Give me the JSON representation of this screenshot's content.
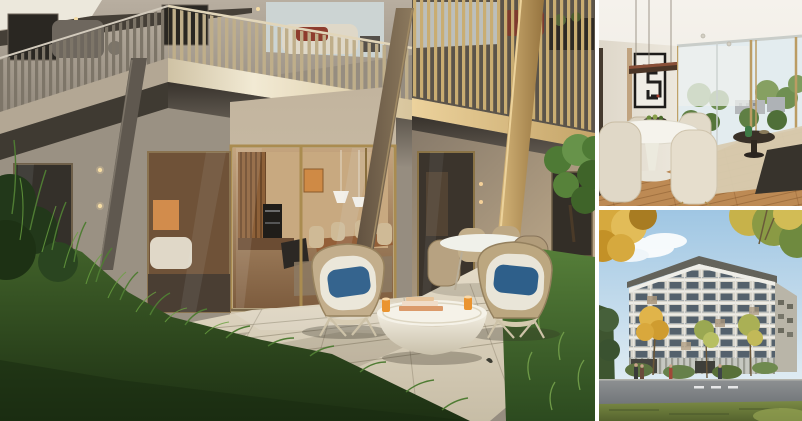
{
  "window": {
    "background": "#ffffff"
  },
  "gallery": {
    "layout": {
      "total_width": 802,
      "total_height": 421,
      "left_panel_width": 595,
      "right_panel_width": 203,
      "right_top_height": 206,
      "right_bottom_height": 211,
      "gap_px": 4,
      "gap_color": "#ffffff"
    },
    "panels": [
      {
        "id": "terrace-exterior",
        "alt": "Rendering of a ground-floor apartment terrace: balconies with vertical slat railings above, open glazed doors showing a warm kitchen and dining room, a stone patio with two rattan lounge chairs with blue cushions, a round white coffee table with books and drinks, an outdoor dining set, and tall grasses in the foreground"
      },
      {
        "id": "dining-interior",
        "alt": "Rendering of a bright dining interior: round white pedestal table with a fruit bowl, cream upholstered chairs, black framed abstract artwork, a dark linear pendant lamp, floor-to-ceiling windows with trees outside and an oak wood floor"
      },
      {
        "id": "building-exterior",
        "alt": "Rendering of a multi-storey residential building with gridded balconies under a blue sky with clouds, framed by autumn trees, with a lawn, street and small figures in the foreground"
      }
    ],
    "palette": {
      "accent_gold": "#b3935a",
      "facade_beige": "#b3a793",
      "railing_tan": "#bfae8a",
      "patio_stone": "#d9d0bc",
      "grass_dark": "#2c4a1f",
      "grass_light": "#4f7c33",
      "cushion_blue_left": "#35648e",
      "cushion_blue_right": "#2e5f8a",
      "art_orange": "#cf8a45",
      "wall_cream": "#e9e4da",
      "wood_floor": "#bd8a54",
      "sky_blue": "#a4c9e4",
      "autumn_yellow": "#d6a93e",
      "building_gray": "#d9d6cc",
      "road_gray": "#85898c"
    }
  }
}
